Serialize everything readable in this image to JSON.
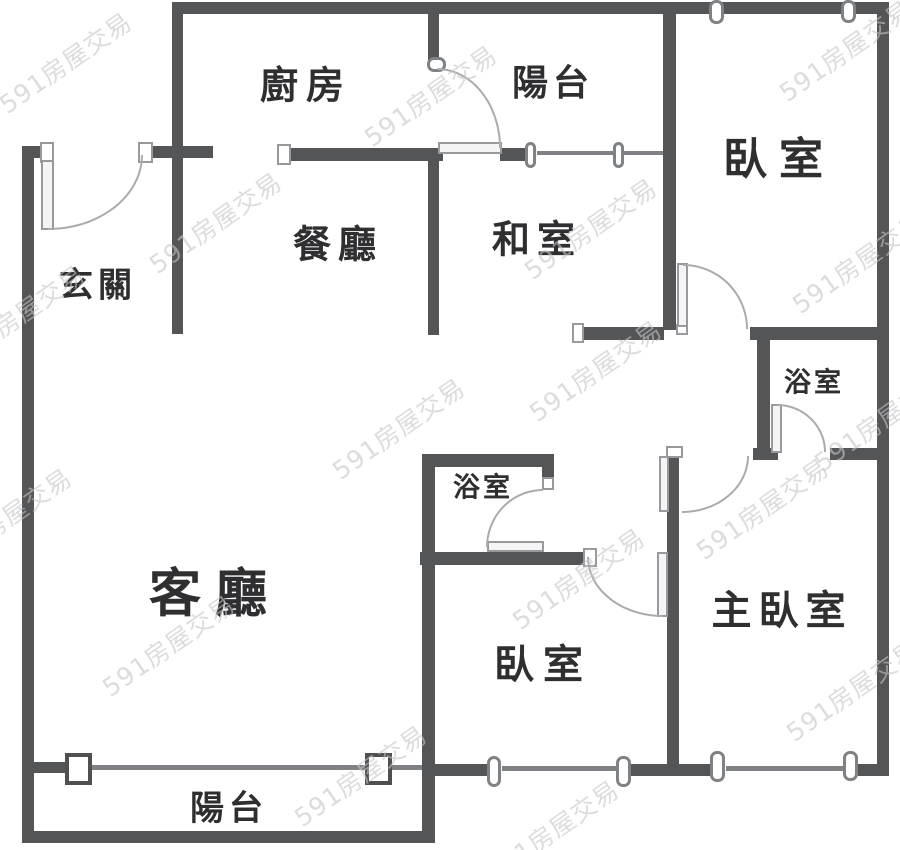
{
  "canvas": {
    "width": 900,
    "height": 850,
    "background": "#ffffff"
  },
  "palette": {
    "wall": "#545557",
    "window_line": "#7f8184",
    "fixture_border": "#98999c",
    "arc": "#a9abae",
    "label": "#2f2f31",
    "watermark": "#c5c6c8"
  },
  "rooms": [
    {
      "id": "kitchen",
      "label": "廚房",
      "cx": 306,
      "cy": 82,
      "fs": 38,
      "ls": 8
    },
    {
      "id": "balcony-top",
      "label": "陽台",
      "cx": 553,
      "cy": 80,
      "fs": 36,
      "ls": 5
    },
    {
      "id": "bedroom-top-right",
      "label": "臥室",
      "cx": 779,
      "cy": 155,
      "fs": 44,
      "ls": 12
    },
    {
      "id": "dining",
      "label": "餐廳",
      "cx": 338,
      "cy": 241,
      "fs": 38,
      "ls": 7
    },
    {
      "id": "tatami",
      "label": "和室",
      "cx": 537,
      "cy": 236,
      "fs": 38,
      "ls": 7
    },
    {
      "id": "foyer",
      "label": "玄關",
      "cx": 98,
      "cy": 282,
      "fs": 34,
      "ls": 5
    },
    {
      "id": "bath-upper",
      "label": "浴室",
      "cx": 814,
      "cy": 380,
      "fs": 27,
      "ls": 3
    },
    {
      "id": "bath-lower",
      "label": "浴室",
      "cx": 483,
      "cy": 485,
      "fs": 27,
      "ls": 3
    },
    {
      "id": "living",
      "label": "客廳",
      "cx": 215,
      "cy": 589,
      "fs": 52,
      "ls": 14
    },
    {
      "id": "master-bedroom",
      "label": "主臥室",
      "cx": 782,
      "cy": 607,
      "fs": 40,
      "ls": 7
    },
    {
      "id": "bedroom-bottom",
      "label": "臥室",
      "cx": 543,
      "cy": 661,
      "fs": 40,
      "ls": 9
    },
    {
      "id": "balcony-bottom",
      "label": "陽台",
      "cx": 229,
      "cy": 805,
      "fs": 34,
      "ls": 5
    }
  ],
  "walls": [
    [
      172,
      2,
      717,
      12
    ],
    [
      22,
      146,
      26,
      12
    ],
    [
      152,
      146,
      61,
      12
    ],
    [
      281,
      148,
      162,
      13
    ],
    [
      500,
      148,
      28,
      13
    ],
    [
      577,
      327,
      87,
      13
    ],
    [
      750,
      327,
      139,
      13
    ],
    [
      753,
      448,
      25,
      12
    ],
    [
      830,
      448,
      59,
      12
    ],
    [
      422,
      454,
      132,
      13
    ],
    [
      420,
      552,
      167,
      13
    ],
    [
      435,
      764,
      56,
      12
    ],
    [
      631,
      764,
      81,
      12
    ],
    [
      858,
      764,
      31,
      12
    ],
    [
      34,
      762,
      33,
      11
    ],
    [
      28,
      831,
      407,
      12
    ],
    [
      22,
      146,
      12,
      697
    ],
    [
      172,
      8,
      11,
      326
    ],
    [
      428,
      8,
      11,
      54
    ],
    [
      428,
      148,
      11,
      187
    ],
    [
      663,
      2,
      13,
      328
    ],
    [
      757,
      333,
      13,
      127
    ],
    [
      667,
      447,
      12,
      318
    ],
    [
      877,
      2,
      12,
      774
    ],
    [
      542,
      454,
      12,
      36
    ],
    [
      422,
      454,
      13,
      389
    ]
  ],
  "window_lines": [
    [
      537,
      151,
      78,
      4
    ],
    [
      624,
      151,
      40,
      4
    ],
    [
      92,
      765,
      274,
      5
    ],
    [
      392,
      765,
      31,
      5
    ],
    [
      502,
      766,
      115,
      5
    ],
    [
      726,
      766,
      118,
      5
    ]
  ],
  "box_windows": [
    [
      65,
      753,
      27,
      32
    ],
    [
      365,
      753,
      27,
      32
    ]
  ],
  "pill_windows": [
    [
      709,
      0,
      15,
      24
    ],
    [
      841,
      0,
      15,
      23
    ],
    [
      525,
      142,
      11,
      26
    ],
    [
      613,
      142,
      11,
      26
    ],
    [
      487,
      756,
      14,
      31
    ],
    [
      616,
      756,
      15,
      31
    ],
    [
      710,
      751,
      15,
      31
    ],
    [
      843,
      751,
      15,
      30
    ],
    [
      427,
      57,
      19,
      15
    ]
  ],
  "jambs": [
    [
      40,
      142,
      14,
      21
    ],
    [
      138,
      142,
      15,
      21
    ],
    [
      277,
      144,
      14,
      21
    ],
    [
      572,
      323,
      12,
      20
    ],
    [
      666,
      446,
      17,
      12
    ],
    [
      542,
      477,
      12,
      13
    ],
    [
      583,
      548,
      14,
      19
    ],
    [
      676,
      324,
      12,
      11
    ]
  ],
  "door_leaves": [
    [
      41,
      160,
      13,
      70
    ],
    [
      438,
      142,
      64,
      12
    ],
    [
      677,
      263,
      11,
      64
    ],
    [
      771,
      404,
      11,
      49
    ],
    [
      659,
      456,
      10,
      56
    ],
    [
      657,
      552,
      11,
      65
    ],
    [
      487,
      541,
      57,
      11
    ]
  ],
  "door_arcs": [
    {
      "cx": 48,
      "cy": 155,
      "rx": 94,
      "ry": 74,
      "a0": -90,
      "a1": 0
    },
    {
      "cx": 437,
      "cy": 148,
      "rx": 63,
      "ry": 79,
      "a0": 90,
      "a1": 0
    },
    {
      "cx": 683,
      "cy": 329,
      "rx": 64,
      "ry": 64,
      "a0": 90,
      "a1": 0
    },
    {
      "cx": 777,
      "cy": 452,
      "rx": 48,
      "ry": 47,
      "a0": 90,
      "a1": 0
    },
    {
      "cx": 682,
      "cy": 456,
      "rx": 66,
      "ry": 56,
      "a0": 0,
      "a1": -90
    },
    {
      "cx": 663,
      "cy": 557,
      "rx": 75,
      "ry": 59,
      "a0": 180,
      "a1": 270
    },
    {
      "cx": 543,
      "cy": 547,
      "rx": 56,
      "ry": 57,
      "a0": 180,
      "a1": 90
    }
  ],
  "watermark": {
    "text": "591房屋交易",
    "rotation_deg": -35,
    "instances": [
      [
        65,
        62
      ],
      [
        430,
        95
      ],
      [
        845,
        50
      ],
      [
        215,
        222
      ],
      [
        590,
        228
      ],
      [
        858,
        262
      ],
      [
        18,
        315
      ],
      [
        595,
        370
      ],
      [
        398,
        428
      ],
      [
        880,
        420
      ],
      [
        762,
        508
      ],
      [
        578,
        578
      ],
      [
        168,
        645
      ],
      [
        852,
        690
      ],
      [
        360,
        775
      ],
      [
        552,
        830
      ],
      [
        5,
        518
      ]
    ]
  }
}
